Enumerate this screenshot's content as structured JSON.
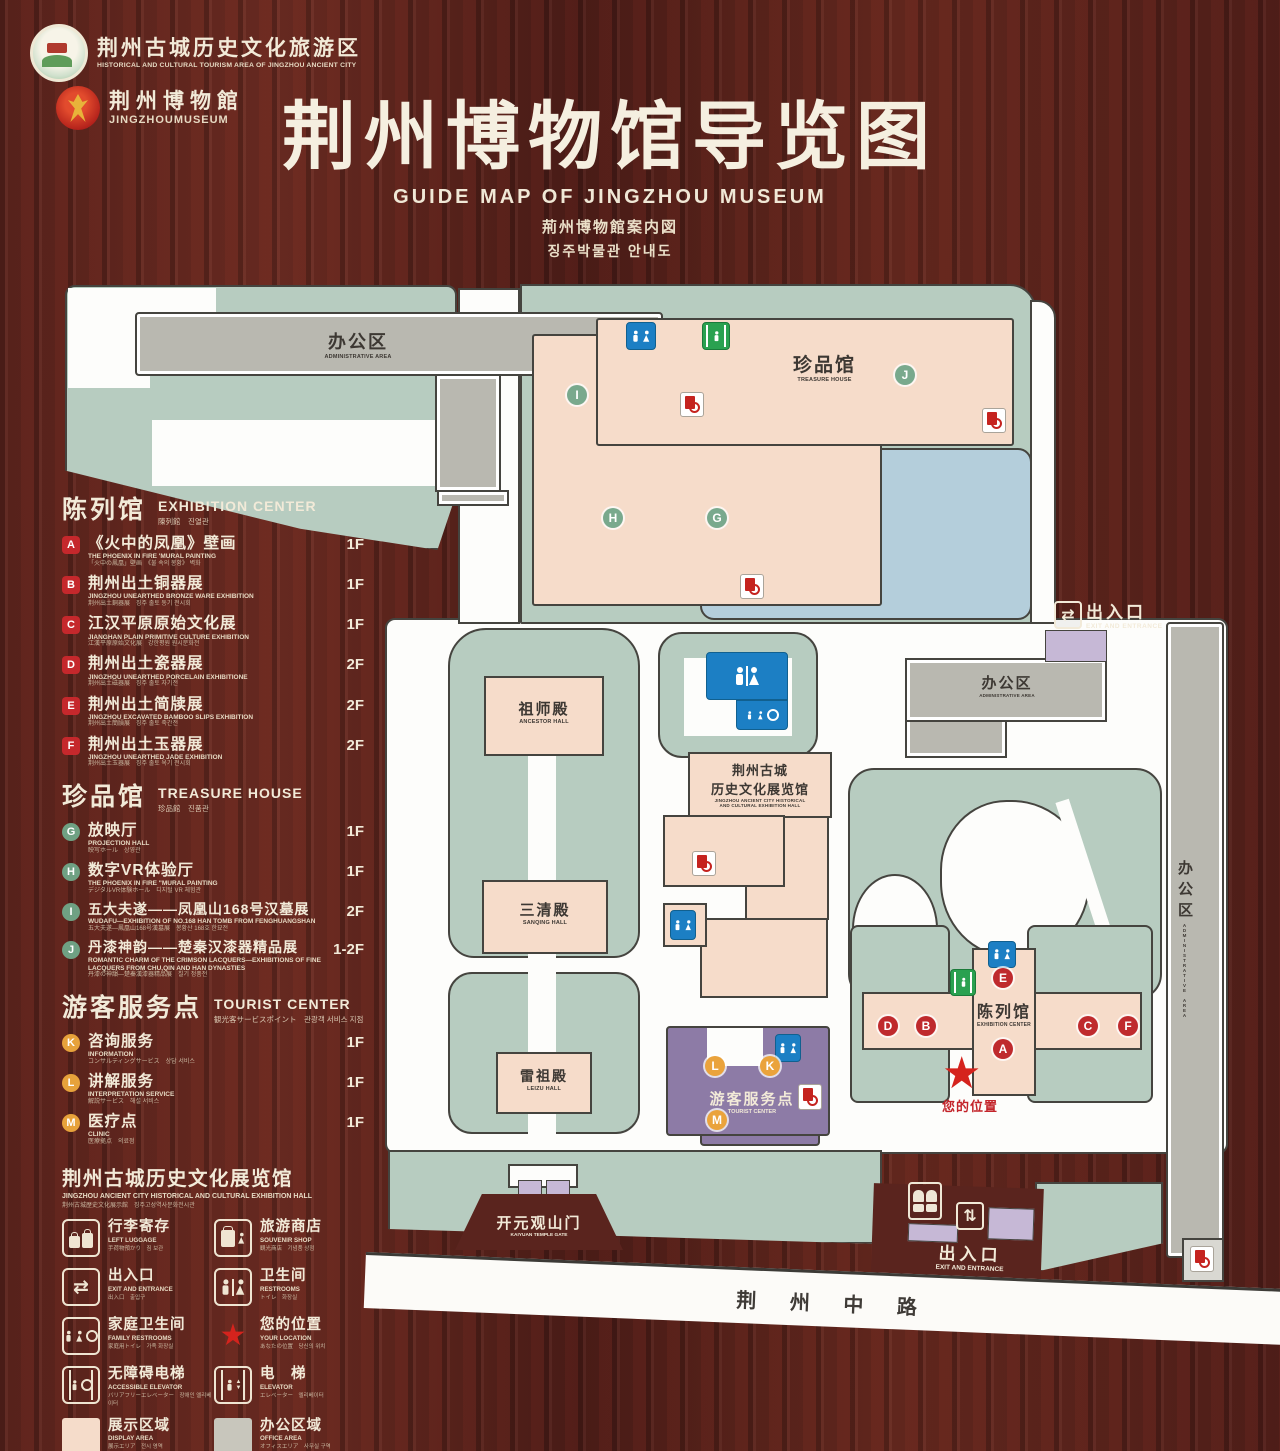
{
  "header": {
    "badge1": {
      "zh": "荆州古城历史文化旅游区",
      "en": "HISTORICAL AND CULTURAL TOURISM AREA OF JINGZHOU ANCIENT CITY"
    },
    "badge2": {
      "zh": "荆州博物館",
      "en": "JINGZHOUMUSEUM"
    },
    "title_zh": "荆州博物馆导览图",
    "title_en": "GUIDE MAP OF JINGZHOU MUSEUM",
    "title_ja": "荊州博物館案内図",
    "title_ko": "징주박물관 안내도"
  },
  "legend": {
    "sections": [
      {
        "title_zh": "陈列馆",
        "title_en": "EXHIBITION CENTER",
        "title_sub": "陳列館　진열관",
        "items": [
          {
            "key": "A",
            "zh": "《火中的凤凰》壁画",
            "en": "THE PHOENIX IN FIRE 'MURAL PAINTING",
            "sub": "「火中の鳳凰」壁画　《불 속의 봉황》 벽화",
            "floor": "1F"
          },
          {
            "key": "B",
            "zh": "荆州出土铜器展",
            "en": "JINGZHOU UNEARTHED BRONZE WARE EXHIBITION",
            "sub": "荆州出土銅器展　징주 출토 동기 전시회",
            "floor": "1F"
          },
          {
            "key": "C",
            "zh": "江汉平原原始文化展",
            "en": "JIANGHAN PLAIN PRIMITIVE CULTURE EXHIBITION",
            "sub": "江漢平原原始文化展　강한평원 원시문화전",
            "floor": "1F"
          },
          {
            "key": "D",
            "zh": "荆州出土瓷器展",
            "en": "JINGZHOU UNEARTHED PORCELAIN EXHIBITIONE",
            "sub": "荆州出土磁器展　징주 출토 자기전",
            "floor": "2F"
          },
          {
            "key": "E",
            "zh": "荆州出土简牍展",
            "en": "JINGZHOU EXCAVATED BAMBOO SLIPS EXHIBITION",
            "sub": "荆州出土簡牘展　징주 출토 죽간전",
            "floor": "2F"
          },
          {
            "key": "F",
            "zh": "荆州出土玉器展",
            "en": "JINGZHOU UNEARTHED JADE EXHIBITION",
            "sub": "荆州出土玉器展　징주 출토 옥기 전시회",
            "floor": "2F"
          }
        ]
      },
      {
        "title_zh": "珍品馆",
        "title_en": "TREASURE HOUSE",
        "title_sub": "珍品館　진품관",
        "items": [
          {
            "key": "G",
            "zh": "放映厅",
            "en": "PROJECTION HALL",
            "sub": "映写ホール　상영관",
            "floor": "1F"
          },
          {
            "key": "H",
            "zh": "数字VR体验厅",
            "en": "THE PHOENIX IN FIRE \"MURAL PAINTING",
            "sub": "デジタルVR体験ホール　디지털 VR 체험관",
            "floor": "1F"
          },
          {
            "key": "I",
            "zh": "五大夫遂——凤凰山168号汉墓展",
            "en": "WUDAFU—EXHIBITION OF NO.168 HAN TOMB FROM FENGHUANGSHAN",
            "sub": "五大夫遂―鳳凰山168号漢墓展　봉황산 168호 한묘전",
            "floor": "2F"
          },
          {
            "key": "J",
            "zh": "丹漆神韵——楚秦汉漆器精品展",
            "en": "ROMANTIC CHARM OF THE CRIMSON LACQUERS—EXHIBITIONS OF FINE LACQUERS FROM CHU,QIN AND HAN DYNASTIES",
            "sub": "丹漆の神韻―楚秦漢漆器精品展　칠기 정품전",
            "floor": "1-2F"
          }
        ]
      },
      {
        "title_zh": "游客服务点",
        "title_en": "TOURIST CENTER",
        "title_sub": "観光客サービスポイント　관광객 서비스 지점",
        "items": [
          {
            "key": "K",
            "zh": "咨询服务",
            "en": "INFORMATION",
            "sub": "コンサルティングサービス　상담 서비스",
            "floor": "1F"
          },
          {
            "key": "L",
            "zh": "讲解服务",
            "en": "INTERPRETATION SERVICE",
            "sub": "解説サービス　해설 서비스",
            "floor": "1F"
          },
          {
            "key": "M",
            "zh": "医疗点",
            "en": "CLINIC",
            "sub": "医療拠点　의료점",
            "floor": "1F"
          }
        ]
      }
    ],
    "hall_note": {
      "zh": "荆州古城历史文化展览馆",
      "en": "JINGZHOU ANCIENT CITY HISTORICAL AND CULTURAL EXHIBITION HALL",
      "sub": "荆州古城歴史文化展示館　징주고성역사문화전시관"
    },
    "icons": [
      {
        "name": "left-luggage-icon",
        "zh": "行李寄存",
        "en": "LEFT LUGGAGE",
        "sub": "手荷物預かり　짐 보관"
      },
      {
        "name": "souvenir-shop-icon",
        "zh": "旅游商店",
        "en": "SOUVENIR SHOP",
        "sub": "観光商店　기념품 상점"
      },
      {
        "name": "exit-entrance-icon",
        "zh": "出入口",
        "en": "EXIT AND ENTRANCE",
        "sub": "出入口　출입구"
      },
      {
        "name": "restrooms-icon",
        "zh": "卫生间",
        "en": "RESTROOMS",
        "sub": "トイレ　화장실"
      },
      {
        "name": "family-restrooms-icon",
        "zh": "家庭卫生间",
        "en": "FAMILY RESTROOMS",
        "sub": "家庭用トイレ　가족 화장실"
      },
      {
        "name": "your-location-icon",
        "zh": "您的位置",
        "en": "YOUR LOCATION",
        "sub": "あなたの位置　당신의 위치"
      },
      {
        "name": "accessible-elevator-icon",
        "zh": "无障碍电梯",
        "en": "ACCESSIBLE ELEVATOR",
        "sub": "バリアフリーエレベーター　장애인 엘리베이터"
      },
      {
        "name": "elevator-icon",
        "zh": "电　梯",
        "en": "ELEVATOR",
        "sub": "エレベーター　엘리베이터"
      },
      {
        "name": "display-area-swatch",
        "zh": "展示区域",
        "en": "DISPLAY AREA",
        "sub": "展示エリア　전시 영역"
      },
      {
        "name": "office-area-swatch",
        "zh": "办公区域",
        "en": "OFFICE AREA",
        "sub": "オフィスエリア　사무실 구역"
      }
    ]
  },
  "map": {
    "labels": {
      "admin_top_zh": "办公区",
      "admin_top_en": "ADMINISTRATIVE AREA",
      "treasure_zh": "珍品馆",
      "treasure_en": "TREASURE HOUSE",
      "exit_top_zh": "出入口",
      "exit_top_en": "EXIT AND ENTRANCE",
      "admin_right_zh": "办公区",
      "admin_right_en": "ADMINISTRATIVE AREA",
      "admin_side_zh": "办公区",
      "admin_side_en": "ADMINISTRATIVE AREA",
      "ancestor_zh": "祖师殿",
      "ancestor_en": "ANCESTOR HALL",
      "hist_zh1": "荆州古城",
      "hist_zh2": "历史文化展览馆",
      "hist_en1": "JINGZHOU ANCIENT CITY HISTORICAL",
      "hist_en2": "AND CULTURAL EXHIBITION HALL",
      "sanqing_zh": "三清殿",
      "sanqing_en": "SANQING HALL",
      "leizu_zh": "雷祖殿",
      "leizu_en": "LEIZU HALL",
      "tourist_zh": "游客服务点",
      "tourist_en": "TOURIST CENTER",
      "exhibition_zh": "陈列馆",
      "exhibition_en": "EXHIBITION CENTER",
      "your_location": "您的位置",
      "kaiyuan_zh": "开元观山门",
      "kaiyuan_en": "KAIYUAN TEMPLE GATE",
      "exit_bottom_zh": "出入口",
      "exit_bottom_en": "EXIT AND ENTRANCE",
      "road": "荆 州 中 路"
    },
    "markers": {
      "treasure": [
        "I",
        "J",
        "H",
        "G"
      ],
      "exhibition": [
        "E",
        "D",
        "B",
        "A",
        "C",
        "F"
      ],
      "tourist": [
        "L",
        "K",
        "M"
      ]
    }
  },
  "colors": {
    "wood": "#56221c",
    "cream": "#f2ead8",
    "green_area": "#b7ccc0",
    "display_area": "#f5dcca",
    "office_area": "#c8c6bc",
    "lake": "#b4cedb",
    "tourist_purple": "#8d7ba6",
    "gate_lavender": "#c6b8d6",
    "marker_red": "#bf2a2d",
    "marker_green": "#79a98d",
    "marker_orange": "#eaa33c",
    "restroom_blue": "#1c7fc4",
    "elevator_green": "#2aa150",
    "location_red": "#d5231d"
  }
}
